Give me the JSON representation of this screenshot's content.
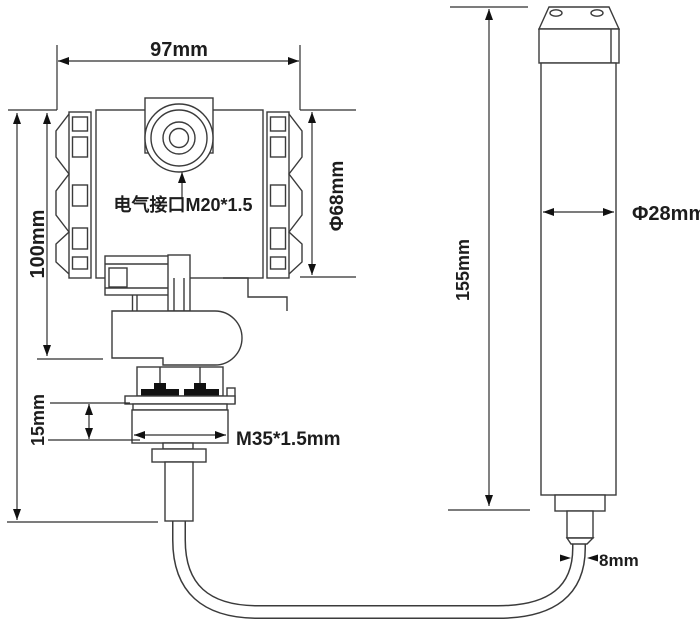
{
  "diagram": {
    "labels": {
      "housing_width": "97mm",
      "housing_height": "100mm",
      "housing_diameter": "Φ68mm",
      "electrical_interface": "电气接口M20*1.5",
      "thread_height": "15mm",
      "thread_spec": "M35*1.5mm",
      "probe_length": "155mm",
      "probe_diameter": "Φ28mm",
      "cable_diameter": "8mm"
    },
    "colors": {
      "background": "#ffffff",
      "line": "#3b3b3b",
      "dimension_line": "#2e2e2e",
      "text": "#1d1d1d",
      "arrow": "#111111",
      "seal": "#111111"
    }
  }
}
